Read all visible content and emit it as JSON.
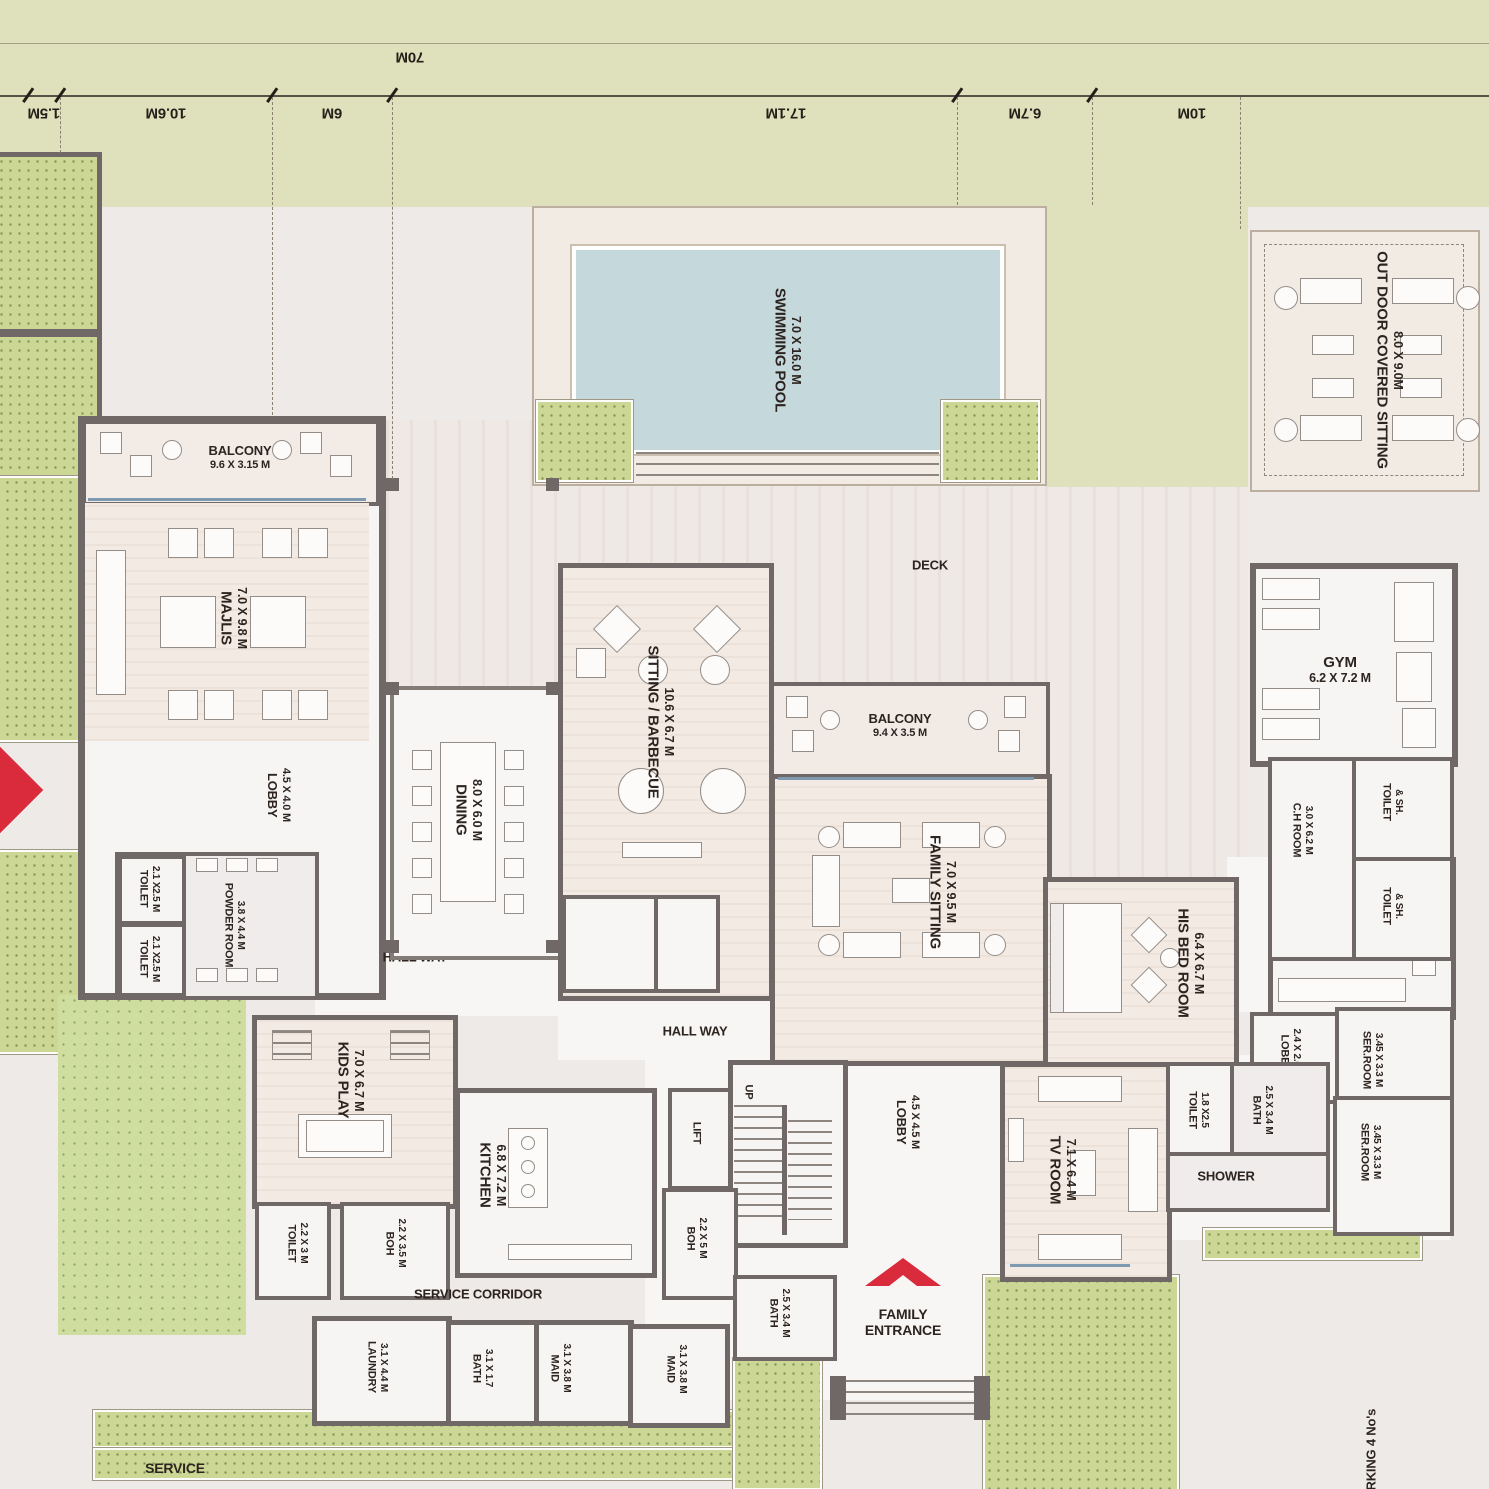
{
  "dimension_line": {
    "total": "70M",
    "segments": [
      "1.5M",
      "10.6M",
      "6M",
      "17.1M",
      "6.7M",
      "10M"
    ]
  },
  "rooms": {
    "swimming_pool": {
      "name": "SWIMMING POOL",
      "dims": "7.0 X 16.0 M"
    },
    "outdoor_sitting": {
      "name": "OUT DOOR COVERED SITTING",
      "dims": "8.0 X 9.0M"
    },
    "balcony_majlis": {
      "name": "BALCONY",
      "dims": "9.6 X 3.15 M"
    },
    "majlis": {
      "name": "MAJLIS",
      "dims": "7.0 X 9.8 M"
    },
    "deck": {
      "name": "DECK"
    },
    "sitting_barbecue": {
      "name": "SITTING / BARBECUE",
      "dims": "10.6 X 6.7 M"
    },
    "dining": {
      "name": "DINING",
      "dims": "8.0 X 6.0 M"
    },
    "balcony_family": {
      "name": "BALCONY",
      "dims": "9.4 X 3.5 M"
    },
    "family_sitting": {
      "name": "FAMILY SITTING",
      "dims": "7.0 X 9.5 M"
    },
    "gym": {
      "name": "GYM",
      "dims": "6.2 X 7.2 M"
    },
    "lobby_main": {
      "name": "LOBBY",
      "dims": "4.5 X 4.0 M"
    },
    "toilet_21": {
      "name": "TOILET",
      "dims": "2.1 X2.5 M"
    },
    "powder_room": {
      "name": "POWDER ROOM",
      "dims": "3.8 X 4.4 M"
    },
    "hall_way": {
      "name": "HALL WAY"
    },
    "ch_room": {
      "name": "C.H ROOM",
      "dims": "3.0 X 6.2 M"
    },
    "toilet_sh": {
      "name": "TOILET",
      "dims": "& SH."
    },
    "his_bed_room": {
      "name": "HIS BED ROOM",
      "dims": "6.4 X 6.7 M"
    },
    "dress": {
      "name": "DRESS",
      "dims": "3.7 X 6.2 M"
    },
    "lobby_his": {
      "name": "LOBBY",
      "dims": "2.4 X 2.6 M"
    },
    "ser_room": {
      "name": "SER.ROOM",
      "dims": "3.45 X 3.3 M"
    },
    "kids_play": {
      "name": "KIDS PLAY",
      "dims": "7.0 X 6.7 M"
    },
    "kitchen": {
      "name": "KITCHEN",
      "dims": "6.8 X 7.2 M"
    },
    "toilet_22": {
      "name": "TOILET",
      "dims": "2.2 X 3 M"
    },
    "boh_35": {
      "name": "BOH",
      "dims": "2.2 X 3.5 M"
    },
    "boh_5": {
      "name": "BOH",
      "dims": "2.2 X 5 M"
    },
    "lift": {
      "name": "LIFT"
    },
    "stairs_up": {
      "name": "UP"
    },
    "service_corridor": {
      "name": "SERVICE CORRIDOR"
    },
    "lobby_family": {
      "name": "LOBBY",
      "dims": "4.5 X 4.5 M"
    },
    "tv_room": {
      "name": "TV ROOM",
      "dims": "7.1 X 6.4 M"
    },
    "toilet_18": {
      "name": "TOILET",
      "dims": "1.8 X2.5"
    },
    "bath_25": {
      "name": "BATH",
      "dims": "2.5 X 3.4 M"
    },
    "shower": {
      "name": "SHOWER"
    },
    "family_entrance": {
      "line1": "FAMILY",
      "line2": "ENTRANCE"
    },
    "laundry": {
      "name": "LAUNDRY",
      "dims": "3.1 X 4.4 M"
    },
    "bath_31": {
      "name": "BATH",
      "dims": "3.1 X 1.7"
    },
    "maid": {
      "name": "MAID",
      "dims": "3.1 X 3.8 M"
    },
    "service": {
      "name": "SERVICE"
    },
    "parking": {
      "name": "PARKING 4 No's"
    }
  },
  "colors": {
    "wall": "#6f6866",
    "water": "#c5d9dc",
    "landscape_green": "#dfe1bd",
    "planter_green": "#ccd795",
    "lawn_green": "#cfdd9e",
    "paving": "#edeae7",
    "deck": "#efe9e5",
    "floor": "#f7f5f3",
    "wood_floor": "#f3ebe3",
    "entrance_red": "#d92b3c",
    "label_text": "#2d2420"
  }
}
